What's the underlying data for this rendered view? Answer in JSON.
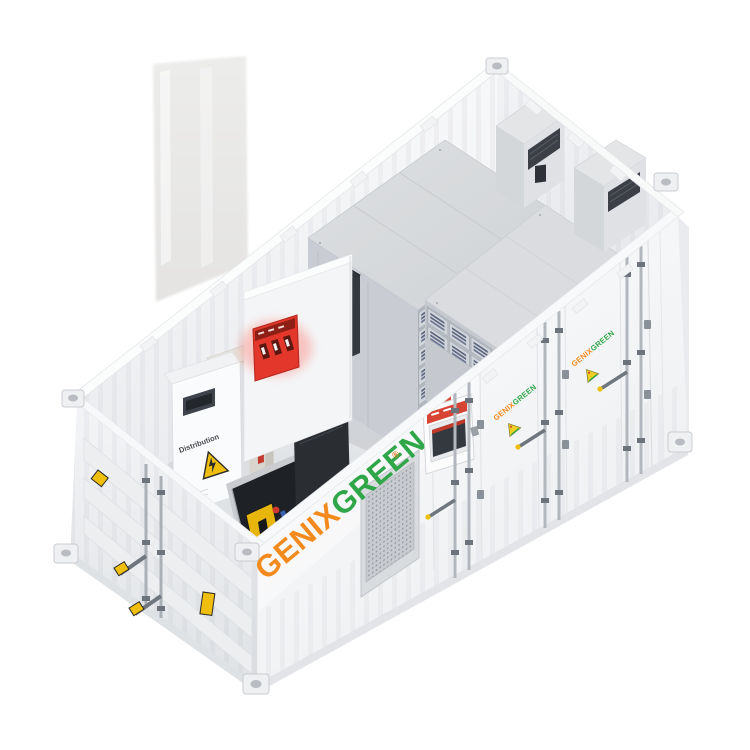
{
  "brand": {
    "name_part1": "GENIX",
    "name_part2": "GREEN",
    "registered_mark": "®"
  },
  "labels": {
    "distribution_cabinet": "Distribution"
  },
  "colors": {
    "brand_orange": "#F28A1E",
    "brand_green": "#2FA648",
    "alarm_red": "#E2372A",
    "warning_yellow": "#EFBE0F",
    "container_shell": "#F6F7F8",
    "rack_module_slot": "#5F6880"
  },
  "icons": {
    "warning_triangle": "high-voltage-warning",
    "brand_triangle": "pyramid-brand-mark"
  }
}
